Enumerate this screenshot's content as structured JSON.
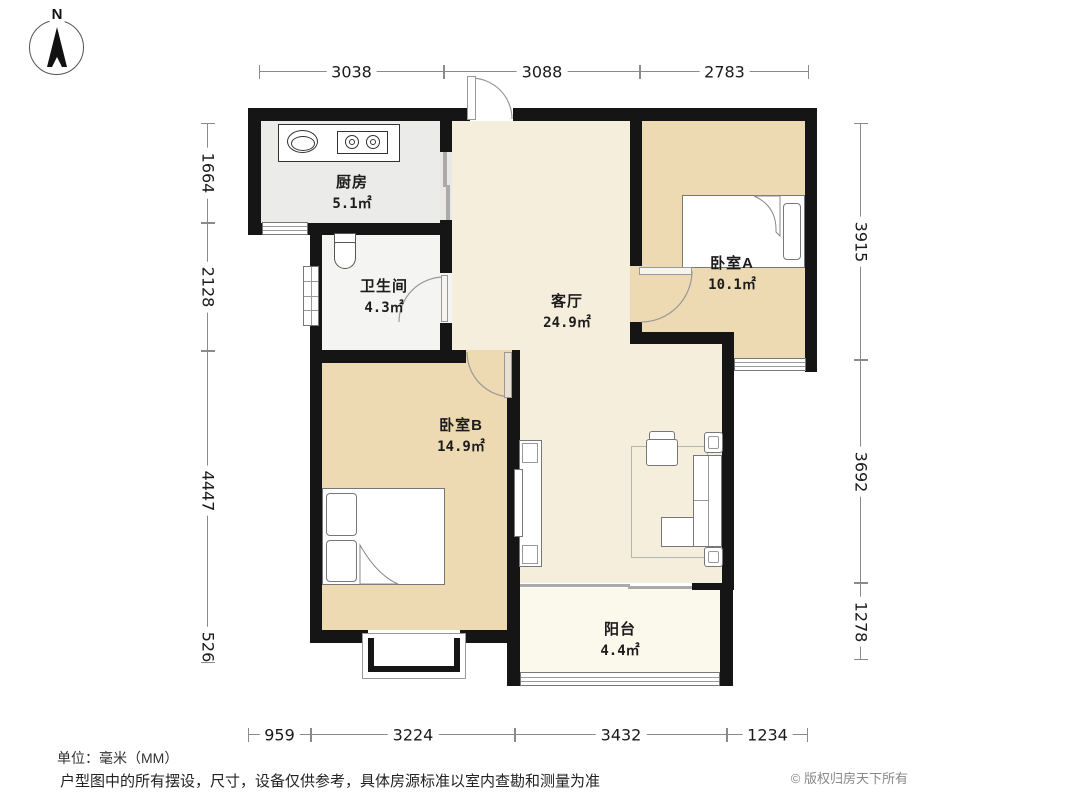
{
  "compass": {
    "label": "N"
  },
  "rooms": [
    {
      "id": "kitchen",
      "name": "厨房",
      "area": "5.1㎡"
    },
    {
      "id": "bathroom",
      "name": "卫生间",
      "area": "4.3㎡"
    },
    {
      "id": "living",
      "name": "客厅",
      "area": "24.9㎡"
    },
    {
      "id": "bedroomA",
      "name": "卧室A",
      "area": "10.1㎡"
    },
    {
      "id": "bedroomB",
      "name": "卧室B",
      "area": "14.9㎡"
    },
    {
      "id": "balcony",
      "name": "阳台",
      "area": "4.4㎡"
    }
  ],
  "dimensions": {
    "unit": "mm",
    "top": [
      "3038",
      "3088",
      "2783"
    ],
    "left": [
      "1664",
      "2128",
      "4447",
      "526"
    ],
    "right": [
      "3915",
      "3692",
      "1278"
    ],
    "bottom": [
      "959",
      "3224",
      "3432",
      "1234"
    ]
  },
  "footer": {
    "unit_note": "单位：毫米（MM）",
    "disclaimer": "户型图中的所有摆设，尺寸，设备仅供参考，具体房源标准以室内查勘和测量为准",
    "copyright": "© 版权归房天下所有"
  },
  "colors": {
    "wall": "#151515",
    "bedroom": "#edd9b2",
    "living": "#f6eedd",
    "kitchen": "#ebebea",
    "bathroom": "#f4f4f2",
    "balcony": "#fbf8ec"
  }
}
